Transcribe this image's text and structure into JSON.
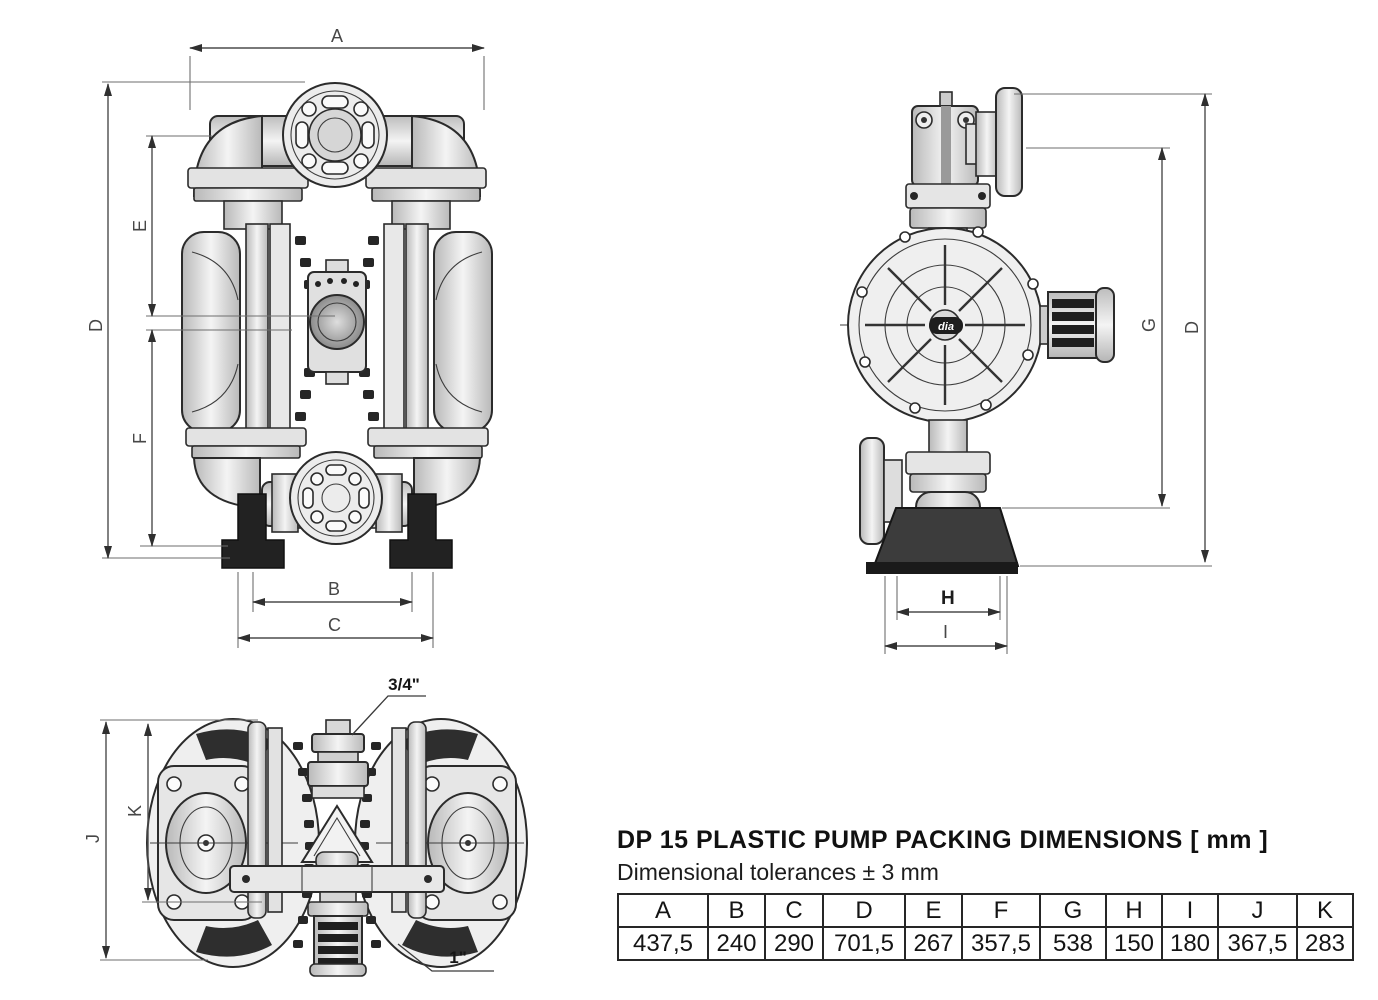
{
  "dims": {
    "a": "A",
    "b": "B",
    "c": "C",
    "d": "D",
    "e": "E",
    "f": "F",
    "g": "G",
    "h": "H",
    "i": "I",
    "j": "J",
    "k": "K"
  },
  "ports": {
    "air_inlet": "3/4\"",
    "outlet": "1\""
  },
  "logo": "dia",
  "table": {
    "title": "DP 15 PLASTIC PUMP PACKING DIMENSIONS [ mm ]",
    "subtitle": "Dimensional tolerances ± 3 mm",
    "headers": [
      "A",
      "B",
      "C",
      "D",
      "E",
      "F",
      "G",
      "H",
      "I",
      "J",
      "K"
    ],
    "values": [
      "437,5",
      "240",
      "290",
      "701,5",
      "267",
      "357,5",
      "538",
      "150",
      "180",
      "367,5",
      "283"
    ]
  },
  "colors": {
    "background": "#ffffff",
    "outline": "#2b2b2b",
    "dimension_line": "#4d4d4d",
    "label": "#474747",
    "dark_fill": "#222222",
    "metal_light": "#f2f2f2",
    "metal_dark": "#bdbdbd"
  }
}
